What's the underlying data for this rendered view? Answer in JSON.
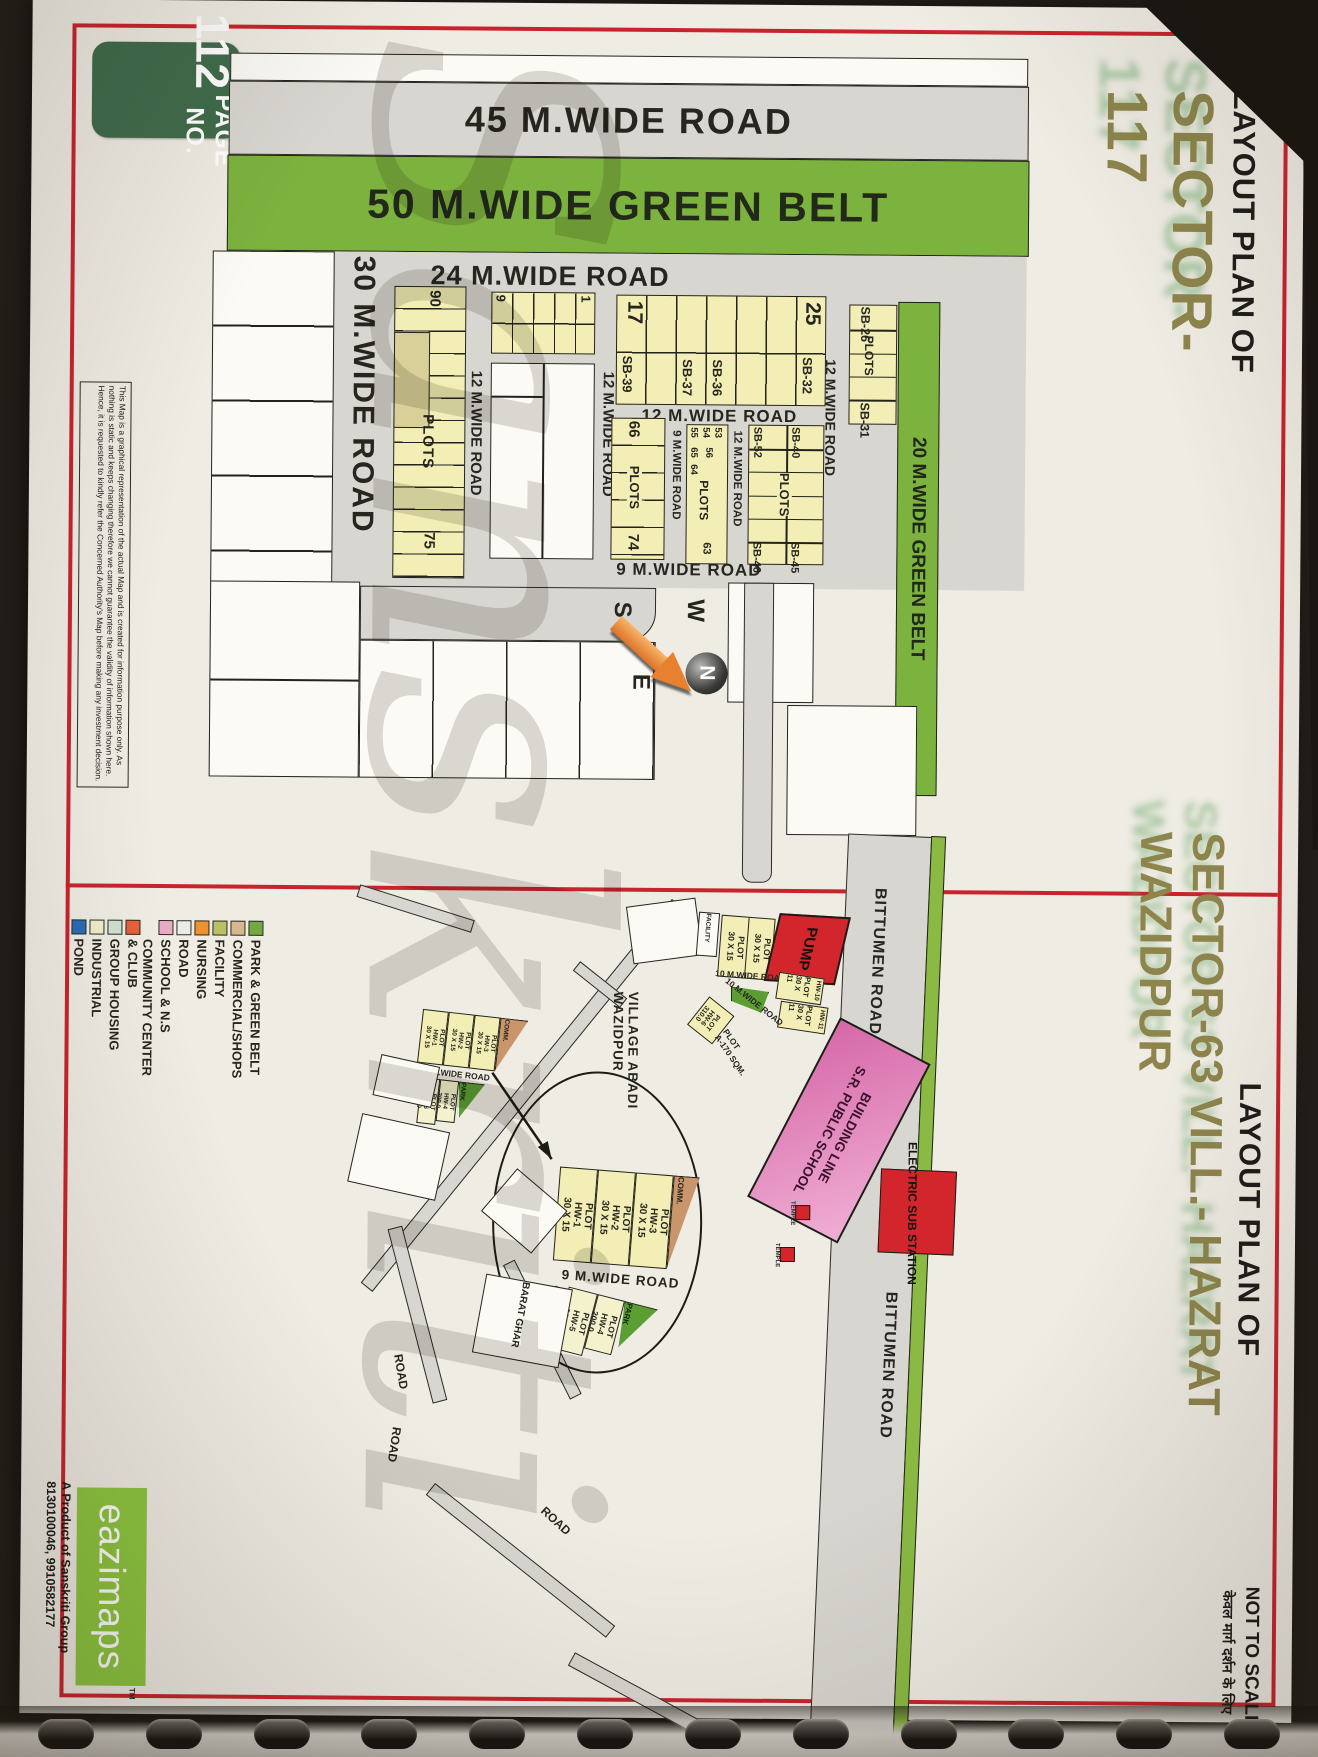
{
  "page": {
    "badge_label": "PAGE NO.",
    "badge_number": "112",
    "watermark": "Sanskriti",
    "not_to_scale": "NOT TO SCALE",
    "hindi_note": "केवल मार्ग दर्शन के लिए",
    "disclaimer": "This Map is a graphical representation of the actual Map and is created for information purpose only. As nothing is static and keeps changing therefore we cannot guarantee the validity of information shown here. Hence, it is requested to kindly refer the Concerned Authority's Map before making any investment decision."
  },
  "publisher": {
    "logo_text": "eazimaps",
    "tm": "TM",
    "product_line1": "A Product of Sanskriti Group",
    "product_line2": "8130100046, 9910582177"
  },
  "sector117": {
    "title_prefix": "LAYOUT PLAN OF",
    "title": "SECTOR-117",
    "roads": {
      "wide45": "45 M.WIDE ROAD",
      "green50": "50 M.WIDE GREEN BELT",
      "wide24": "24 M.WIDE ROAD",
      "wide30": "30 M.WIDE ROAD",
      "green20": "20 M.WIDE GREEN BELT",
      "wide12": "12 M.WIDE ROAD",
      "wide9": "9 M.WIDE ROAD"
    },
    "plots": {
      "plots_word": "PLOTS",
      "n90": "90",
      "n75": "75",
      "n9": "9",
      "n1": "1",
      "n17": "17",
      "n25": "25",
      "n66": "66",
      "n74": "74",
      "n55": "55",
      "n54": "54",
      "n53": "53",
      "n65": "65",
      "n56": "56",
      "n64": "64",
      "n63": "63",
      "sb26": "SB-26",
      "sb31": "SB-31",
      "sb32": "SB-32",
      "sb36": "SB-36",
      "sb37": "SB-37",
      "sb39": "SB-39",
      "sb40": "SB-40",
      "sb45": "SB-45",
      "sb46": "SB-46",
      "sb52": "SB-52"
    },
    "compass": {
      "north": "N",
      "south": "S",
      "east": "E",
      "west": "W"
    }
  },
  "sector63": {
    "title_prefix": "LAYOUT PLAN OF",
    "title": "SECTOR-63 VILL.- HAZRAT WAZIDPUR",
    "legend": [
      {
        "label": "POND",
        "color": "#2a6cb5"
      },
      {
        "label": "INDUSTRIAL",
        "color": "#efeec8"
      },
      {
        "label": "GROUP HOUSING",
        "color": "#cfe1cf"
      },
      {
        "label": "COMMUNITY CENTER\n& CLUB",
        "color": "#e8603a"
      },
      {
        "label": "SCHOOL & N.S",
        "color": "#e9aac6"
      },
      {
        "label": "ROAD",
        "color": "#ebebe5"
      },
      {
        "label": "NURSING",
        "color": "#ef9130"
      },
      {
        "label": "FACILITY",
        "color": "#b9bf63"
      },
      {
        "label": "COMMERCIAL/SHOPS",
        "color": "#d7b690"
      },
      {
        "label": "PARK & GREEN BELT",
        "color": "#72a943"
      }
    ],
    "features": {
      "pump": "PUMP",
      "facility": "FACILITY",
      "school_line1": "BUILDING LINE",
      "school_line2": "S.R. PUBLIC SCHOOL",
      "electric": "ELECTRIC SUB STATION",
      "temple": "TEMPLE",
      "village": "VILLAGE ABADI WAZIDPUR",
      "bittumen": "BITTUMEN ROAD",
      "barat_ghar": "BARAT GHAR",
      "road_word": "ROAD",
      "park": "PARK",
      "comm": "COMM.",
      "road9": "9 M.WIDE ROAD",
      "road10": "10 M.WIDE ROAD",
      "plot_a170": "PLOT\nA-170 SQM.",
      "plot30x15": "PLOT\n30 X 15",
      "plot30x11": "PLOT\n30 X 11",
      "hw10": "HW-10",
      "hw11": "HW-11",
      "hw1": "PLOT\nHW-1\n30 X 15",
      "hw2": "PLOT\nHW-2\n30 X 15",
      "hw3": "PLOT\nHW-3\n30 X 15",
      "hw4": "PLOT\nHW-4\n200.0",
      "hw5": "PLOT\nHW-5\n328.0",
      "hw6": "PLOT\nHW-6\n310.0"
    }
  }
}
